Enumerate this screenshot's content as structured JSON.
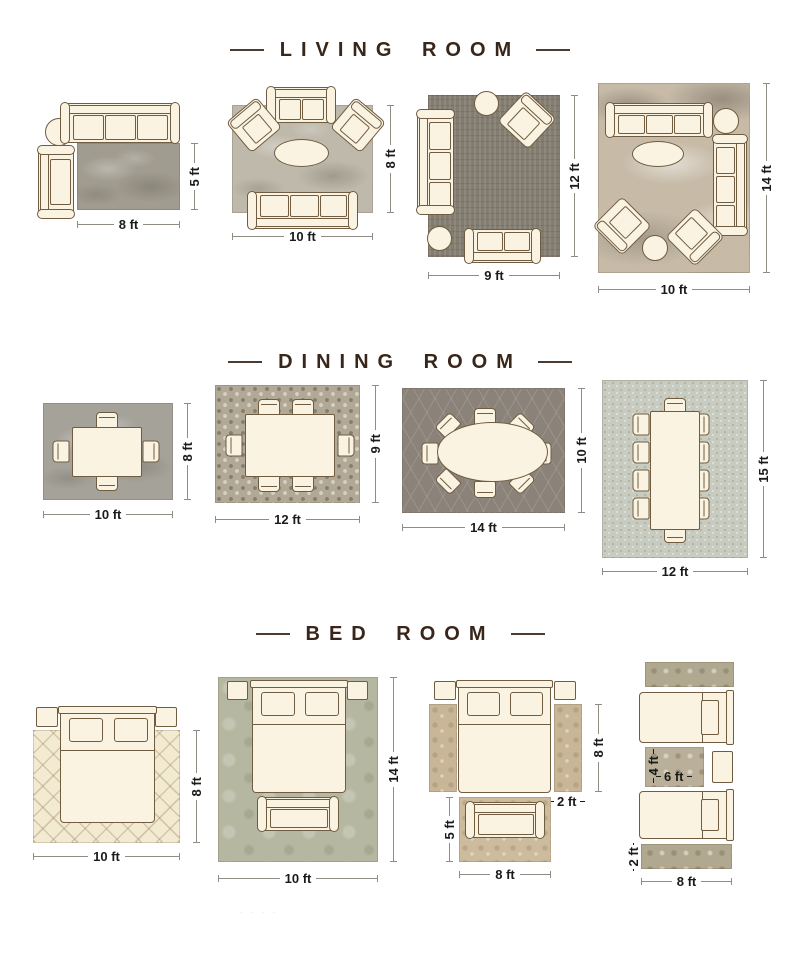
{
  "page": {
    "watermark": "· · · ·"
  },
  "palette": {
    "title_color": "#39261a",
    "dim_text_color": "#1a1a18",
    "dim_line_color": "#908c84",
    "furniture_fill": "#faf3e1",
    "furniture_border": "#6f5c41"
  },
  "sections": {
    "living": {
      "title": "LIVING ROOM"
    },
    "dining": {
      "title": "DINING ROOM"
    },
    "bedroom": {
      "title": "BED ROOM"
    }
  },
  "living": [
    {
      "width_label": "8 ft",
      "height_label": "5 ft",
      "rug_color": "#a19c90"
    },
    {
      "width_label": "10 ft",
      "height_label": "8 ft",
      "rug_color": "#bfb9ab"
    },
    {
      "width_label": "9 ft",
      "height_label": "12 ft",
      "rug_color": "#837c70"
    },
    {
      "width_label": "10 ft",
      "height_label": "14 ft",
      "rug_color": "#c7bba8"
    }
  ],
  "dining": [
    {
      "width_label": "10 ft",
      "height_label": "8 ft",
      "rug_color": "#a5a29a",
      "chairs": 4
    },
    {
      "width_label": "12 ft",
      "height_label": "9 ft",
      "rug_color": "#b2a896",
      "chairs": 6
    },
    {
      "width_label": "14 ft",
      "height_label": "10 ft",
      "rug_color": "#8b8379",
      "chairs": 8
    },
    {
      "width_label": "12 ft",
      "height_label": "15 ft",
      "rug_color": "#c8cbbf",
      "chairs": 10
    }
  ],
  "bedroom": [
    {
      "width_label": "10 ft",
      "height_label": "8 ft",
      "rug_color": "#f3ead2"
    },
    {
      "width_label": "10 ft",
      "height_label": "14 ft",
      "rug_color": "#b5b7a0"
    },
    {
      "runner_height_label": "8 ft",
      "runner_width_label": "2 ft",
      "bench_rug_height_label": "5 ft",
      "bench_rug_width_label": "8 ft",
      "runner_color": "#c8b697",
      "bench_rug_color": "#cdbb9e"
    },
    {
      "mid_rug_height_label": "4 ft",
      "mid_rug_width_label": "6 ft",
      "runner_height_label": "2 ft",
      "runner_width_label": "8 ft",
      "runner_color": "#b1a890",
      "mid_rug_color": "#bab09a"
    }
  ]
}
